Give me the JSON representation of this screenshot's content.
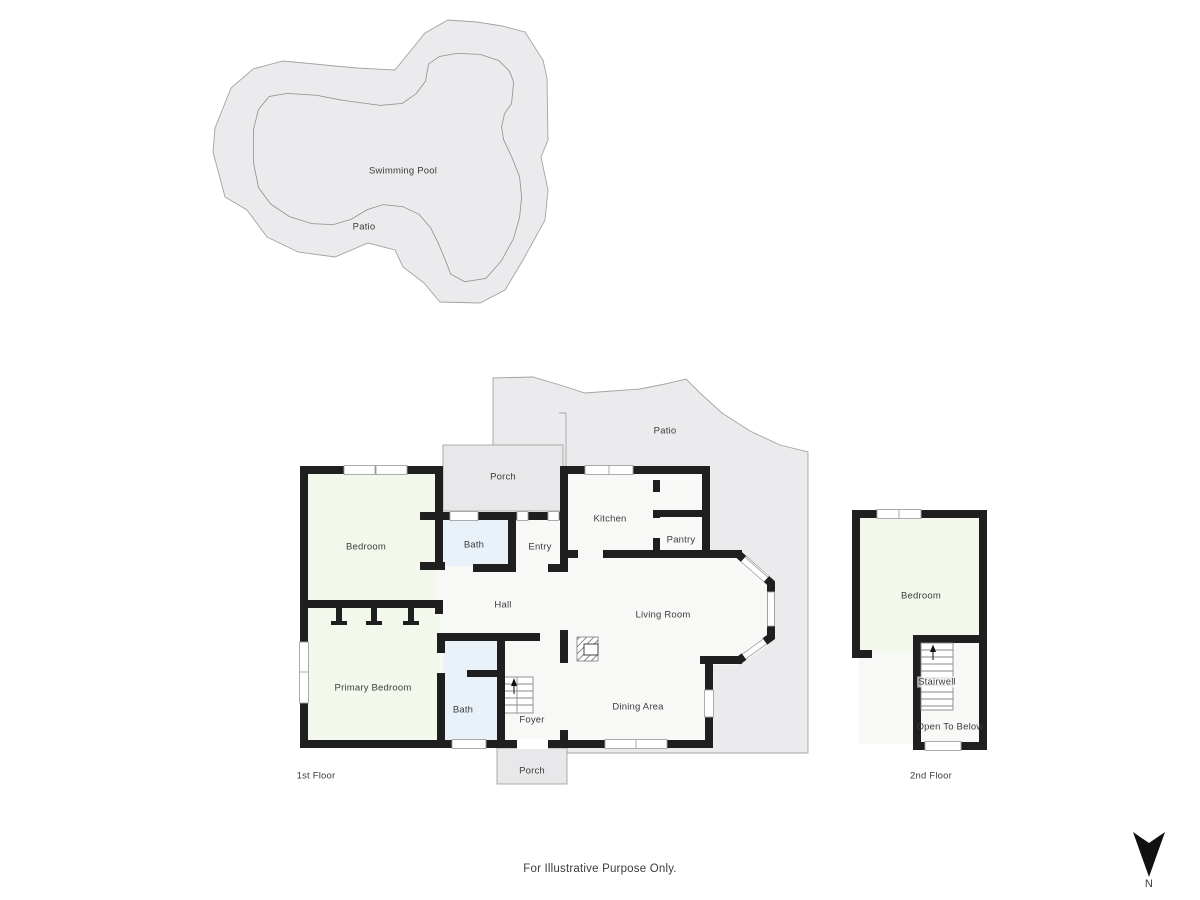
{
  "colors": {
    "wall": "#1f1f1f",
    "floor": "#f8f8f7",
    "bedroom": "#f3f8ed",
    "bath": "#eaf2f9",
    "porch": "#e8e8ea",
    "patio": "#ebebed",
    "outline": "#a3a3a3",
    "text": "#3c3c3c"
  },
  "pool_area": {
    "swimming_pool": "Swimming Pool",
    "patio": "Patio"
  },
  "first_floor": {
    "floor_label": "1st Floor",
    "rooms": {
      "porch_top": "Porch",
      "bedroom": "Bedroom",
      "bath_top": "Bath",
      "entry": "Entry",
      "kitchen": "Kitchen",
      "pantry": "Pantry",
      "patio": "Patio",
      "hall": "Hall",
      "living_room": "Living Room",
      "dining_area": "Dining Area",
      "primary_bedroom": "Primary Bedroom",
      "bath_bottom": "Bath",
      "foyer": "Foyer",
      "porch_bottom": "Porch"
    }
  },
  "second_floor": {
    "floor_label": "2nd Floor",
    "rooms": {
      "bedroom": "Bedroom",
      "stairwell": "Stairwell",
      "open_to_below": "Open To Below"
    }
  },
  "footer": {
    "disclaimer": "For Illustrative Purpose Only."
  },
  "compass": {
    "north_label": "N"
  }
}
